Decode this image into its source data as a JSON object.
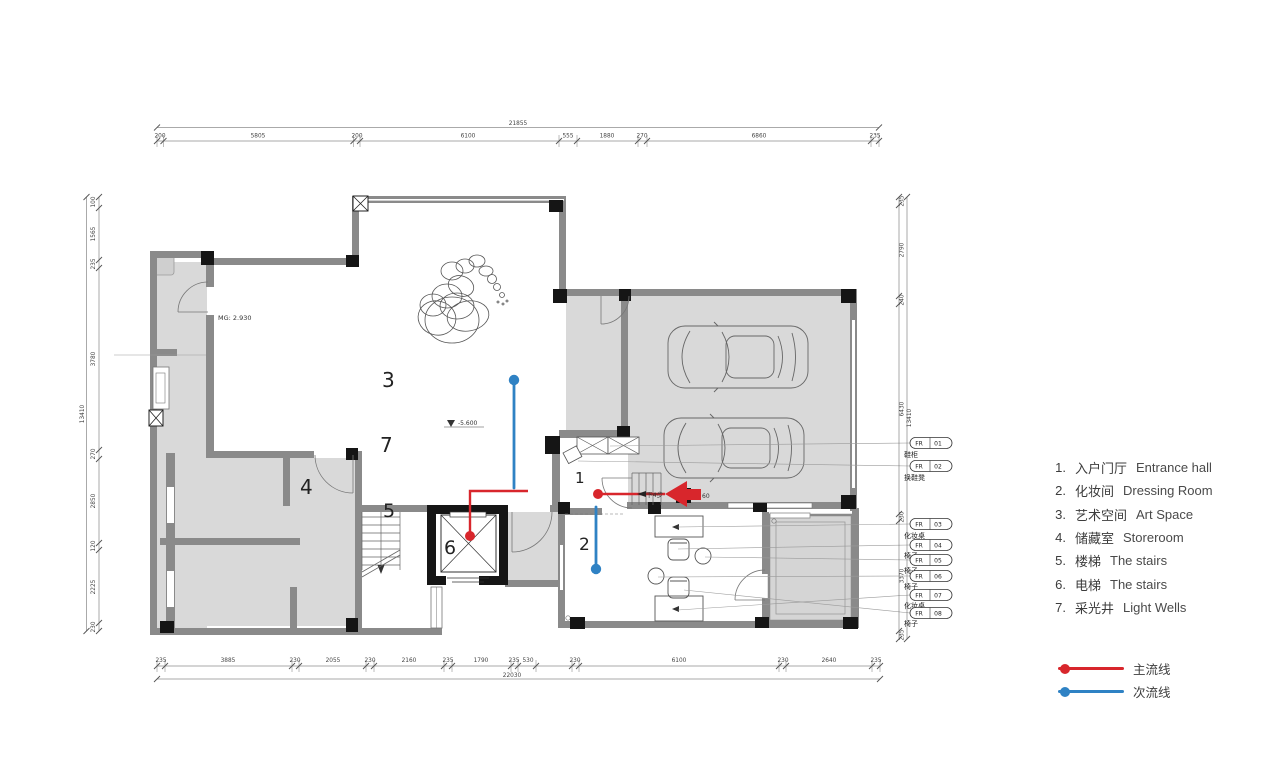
{
  "plan": {
    "room_numbers": [
      "3",
      "7",
      "4",
      "5",
      "6",
      "1",
      "2"
    ],
    "annotations": {
      "mg": "MG: 2.930",
      "level": "-5.600",
      "steps": "下4步",
      "steps_num": "60"
    },
    "fr_tags": [
      {
        "code": "FR",
        "num": "01",
        "item": "鞋柜"
      },
      {
        "code": "FR",
        "num": "02",
        "item": "换鞋凳"
      },
      {
        "code": "FR",
        "num": "03",
        "item": "化妆桌"
      },
      {
        "code": "FR",
        "num": "04",
        "item": "椅子"
      },
      {
        "code": "FR",
        "num": "05",
        "item": "椅子"
      },
      {
        "code": "FR",
        "num": "06",
        "item": "椅子"
      },
      {
        "code": "FR",
        "num": "07",
        "item": "化妆桌"
      },
      {
        "code": "FR",
        "num": "08",
        "item": "椅子"
      }
    ]
  },
  "dims": {
    "top": {
      "total": "21855",
      "segments": [
        "200",
        "5805",
        "200",
        "6100",
        "555",
        "1880",
        "270",
        "6860",
        "235"
      ]
    },
    "bottom": {
      "total": "22030",
      "segments": [
        "235",
        "3885",
        "230",
        "2055",
        "230",
        "2160",
        "235",
        "1790",
        "235",
        "530",
        "230",
        "6100",
        "230",
        "2640",
        "235"
      ]
    },
    "left": {
      "total": "13410",
      "segments": [
        "100",
        "1565",
        "235",
        "3780",
        "270",
        "2850",
        "120",
        "2225",
        "230"
      ]
    },
    "right": {
      "total": "13410",
      "segments": [
        "235",
        "2790",
        "240",
        "6430",
        "230",
        "3370",
        "235"
      ]
    }
  },
  "legend": {
    "rooms": [
      {
        "num": "1.",
        "zh": "入户门厅",
        "en": "Entrance  hall"
      },
      {
        "num": "2.",
        "zh": "化妆间",
        "en": "Dressing Room"
      },
      {
        "num": "3.",
        "zh": "艺术空间",
        "en": "Art Space"
      },
      {
        "num": "4.",
        "zh": "储藏室",
        "en": "Storeroom"
      },
      {
        "num": "5.",
        "zh": "楼梯",
        "en": "The stairs"
      },
      {
        "num": "6.",
        "zh": "电梯",
        "en": "The stairs"
      },
      {
        "num": "7.",
        "zh": "采光井",
        "en": "Light Wells"
      }
    ],
    "flows": [
      {
        "label": "主流线"
      },
      {
        "label": "次流线"
      }
    ]
  },
  "colors": {
    "main_flow": "#d8262c",
    "secondary_flow": "#2f82c4",
    "wall": "#8a8a8a",
    "floor": "#d9d9d9"
  }
}
